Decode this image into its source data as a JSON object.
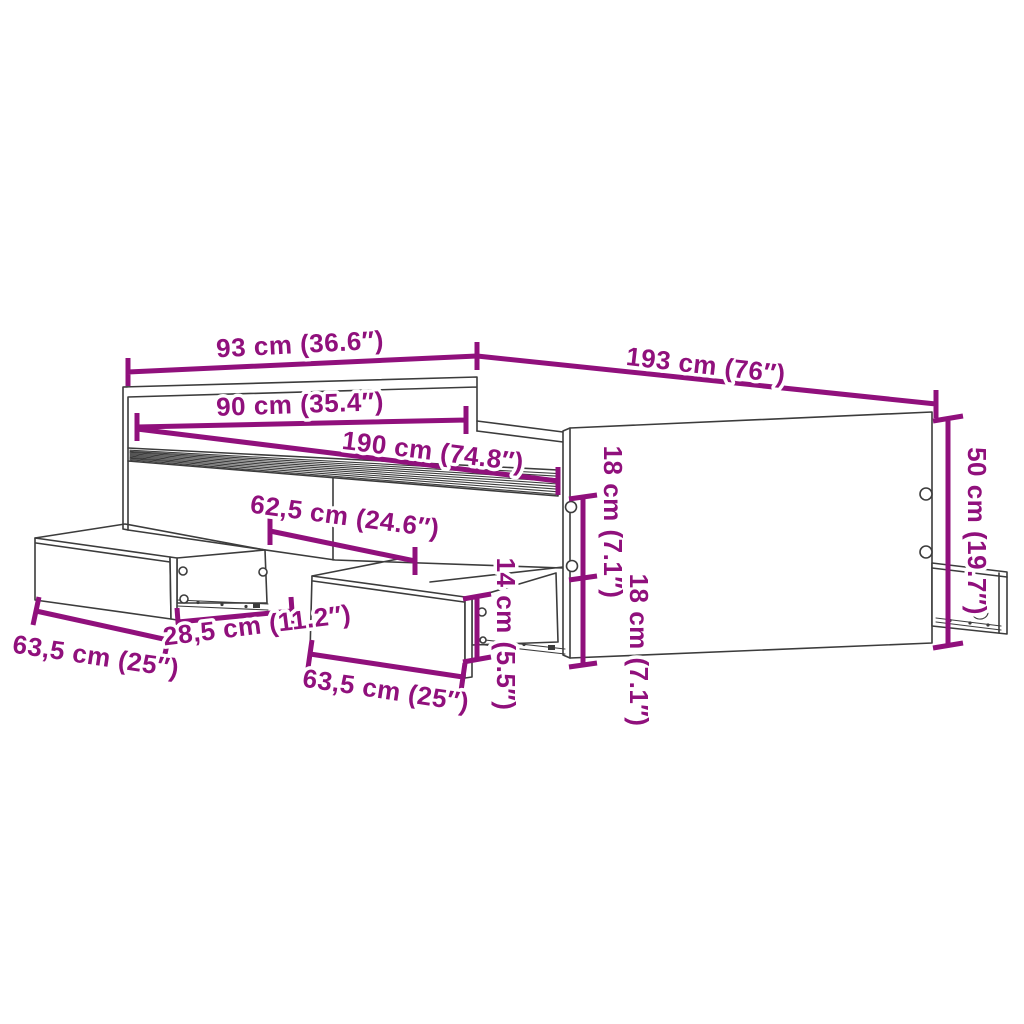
{
  "diagram": {
    "accent_color": "#90107C",
    "line_color": "#3C3C3C",
    "background_color": "#FFFFFF",
    "dimensions": {
      "headboard_width": "93 cm (36.6″)",
      "frame_length": "193 cm (76″)",
      "mattress_width": "90 cm (35.4″)",
      "mattress_length": "190 cm (74.8″)",
      "drawer_offset_from_head": "62,5 cm (24.6″)",
      "rail_upper_height": "18 cm (7.1″)",
      "rail_lower_height": "18 cm (7.1″)",
      "end_panel_height": "50 cm (19.7″)",
      "left_drawer_width": "63,5 cm (25″)",
      "drawer_gap": "28,5 cm (11.2″)",
      "middle_drawer_width": "63,5 cm (25″)",
      "drawer_front_height": "14 cm (5.5″)"
    }
  }
}
